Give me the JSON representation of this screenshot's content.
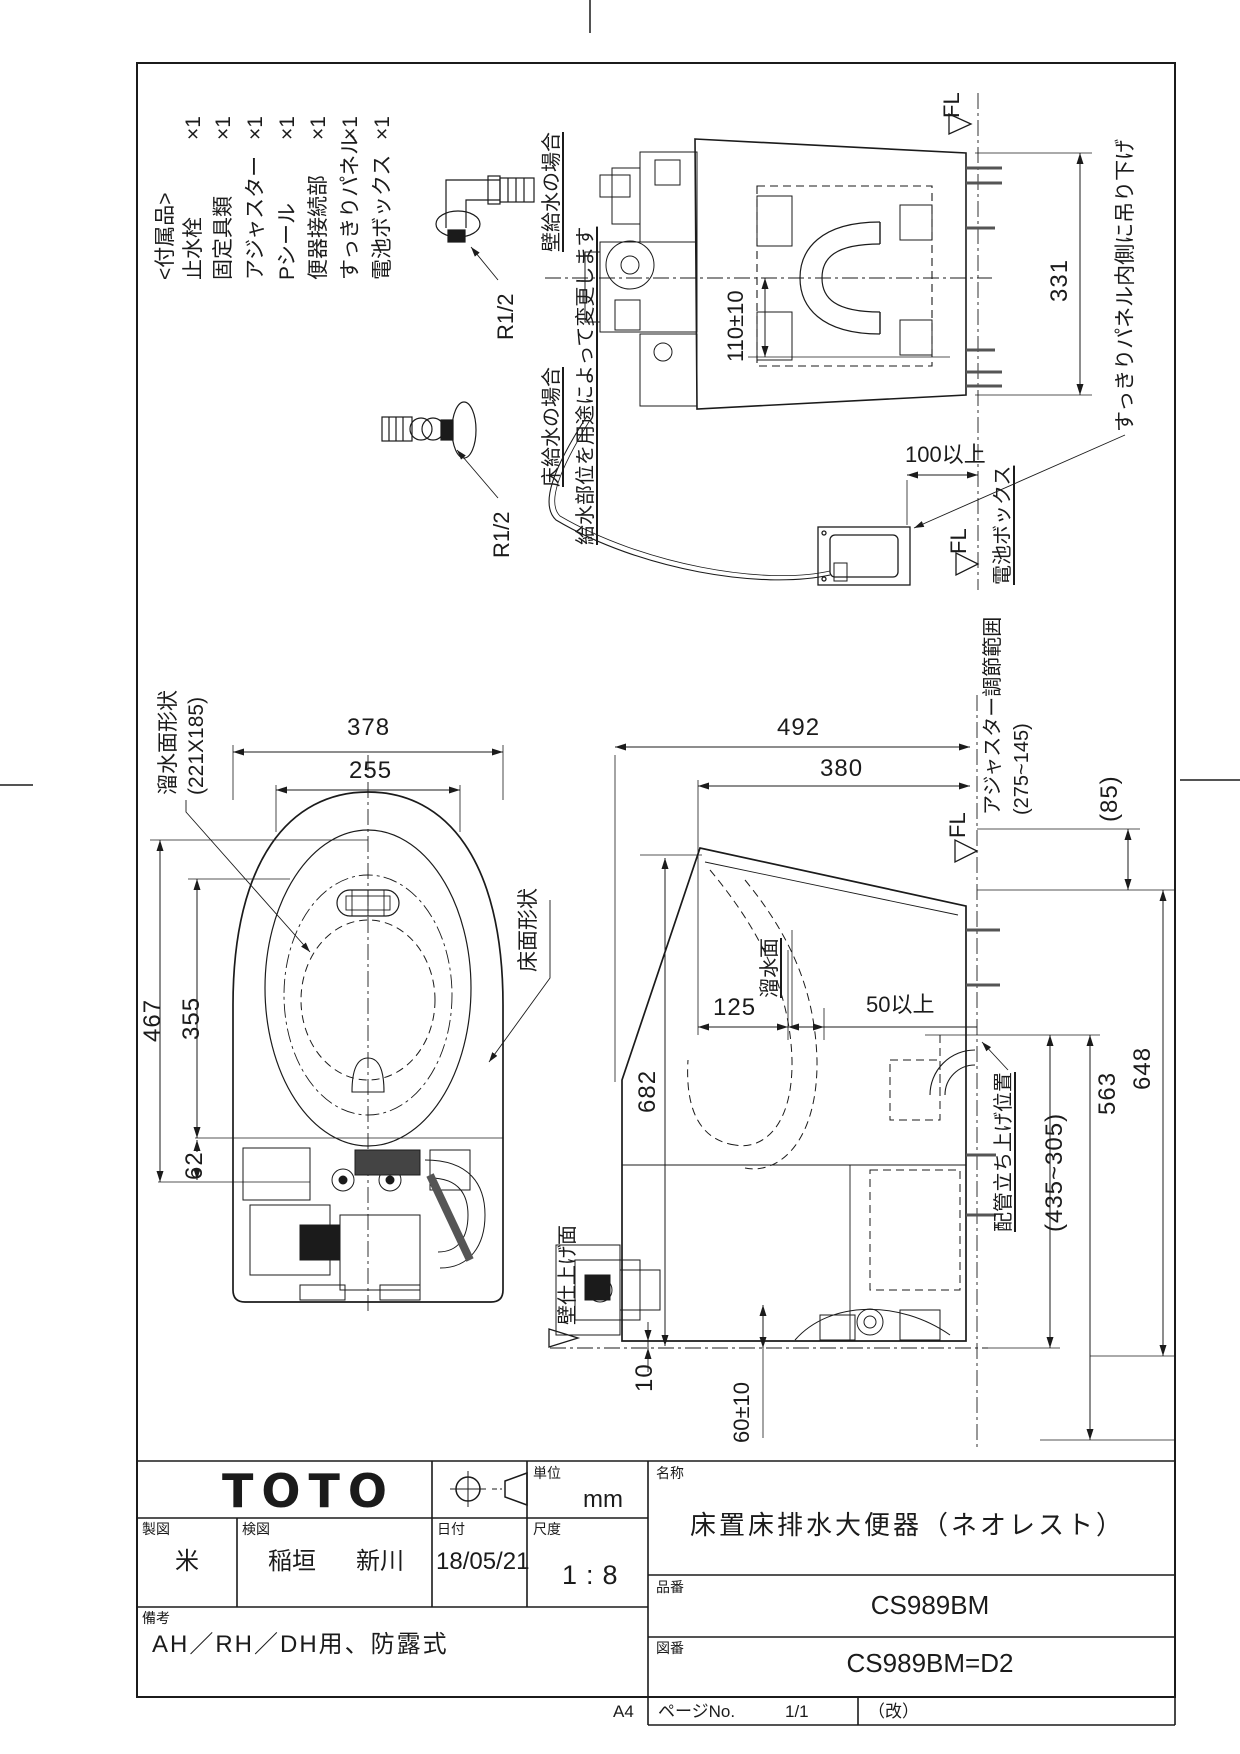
{
  "drawing": {
    "fl": "FL",
    "parts_list": {
      "header": "<付属品>",
      "items": [
        {
          "name": "止水栓",
          "qty": "×1"
        },
        {
          "name": "固定具類",
          "qty": "×1"
        },
        {
          "name": "アジャスター",
          "qty": "×1"
        },
        {
          "name": "Pシール",
          "qty": "×1"
        },
        {
          "name": "便器接続部",
          "qty": "×1"
        },
        {
          "name": "すっきりパネル",
          "qty": "×1"
        },
        {
          "name": "電池ボックス",
          "qty": "×1"
        }
      ]
    },
    "supply": {
      "wall_case": "壁給水の場合",
      "floor_case": "床給水の場合",
      "thread": "R1/2",
      "note": "給水部位を用途によって変更します"
    },
    "rear_view": {
      "dim_panel": "331",
      "dim_center": "110±10",
      "hang_note": "すっきりパネル内側に吊り下げ",
      "battery_label": "電池ボックス",
      "battery_clearance": "100以上"
    },
    "plan_view": {
      "dim_width": "378",
      "dim_seat": "255",
      "dim_depth": "467",
      "dim_bowl": "355",
      "dim_rear": "62",
      "water_label": "溜水面形状",
      "water_size": "(221X185)",
      "floor_label": "床面形状"
    },
    "side_view": {
      "dim_492": "492",
      "dim_380": "380",
      "dim_682": "682",
      "dim_125": "125",
      "dim_50": "50以上",
      "dim_563": "563",
      "dim_648": "648",
      "dim_85": "(85)",
      "dim_pipe_range": "(435~305)",
      "dim_gap": "10",
      "dim_supply": "60±10",
      "adjuster1": "アジャスター調節範囲",
      "adjuster2": "(275~145)",
      "water_surface": "溜水面",
      "pipe_label": "配管立ち上げ位置",
      "wall_label": "壁仕上げ面"
    }
  },
  "title_block": {
    "logo": "TOTO",
    "unit_label": "単位",
    "unit": "mm",
    "drafter_label": "製図",
    "drafter": "米",
    "checker_label": "検図",
    "checker1": "稲垣",
    "checker2": "新川",
    "date_label": "日付",
    "date": "18/05/21",
    "scale_label": "尺度",
    "scale": "1:8",
    "remarks_label": "備考",
    "remarks": "AH／RH／DH用、防露式",
    "name_label": "名称",
    "name": "床置床排水大便器（ネオレスト）",
    "part_no_label": "品番",
    "part_no": "CS989BM",
    "dwg_no_label": "図番",
    "dwg_no": "CS989BM=D2",
    "page_label": "ページNo.",
    "page": "1/1",
    "rev": "（改）",
    "paper": "A4"
  }
}
